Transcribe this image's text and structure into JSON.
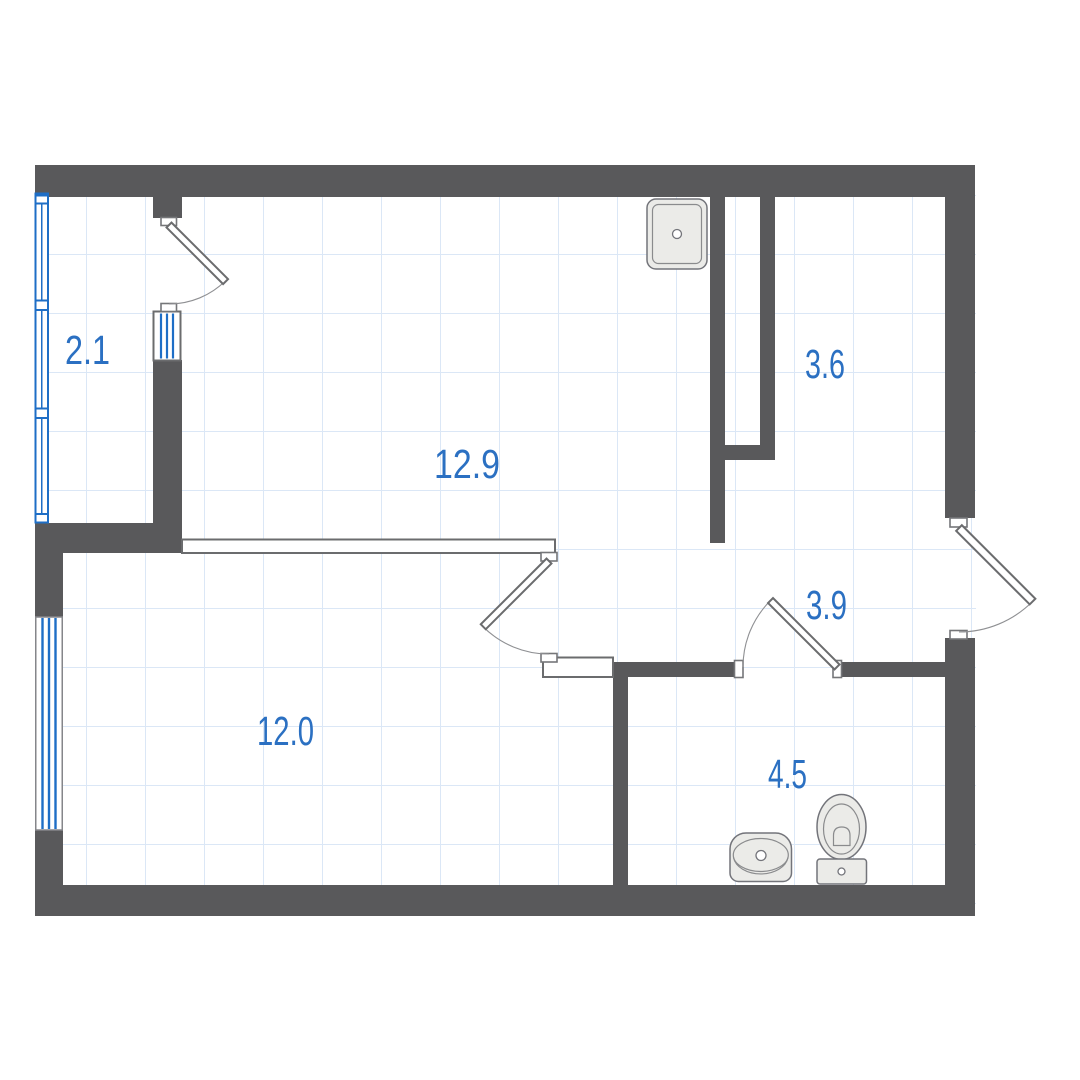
{
  "floorplan": {
    "type": "apartment-floor-plan",
    "rooms": [
      {
        "name": "balcony",
        "area": "2.1"
      },
      {
        "name": "living-room-kitchen",
        "area": "12.9"
      },
      {
        "name": "hall",
        "area": "3.6"
      },
      {
        "name": "corridor",
        "area": "3.9"
      },
      {
        "name": "bedroom",
        "area": "12.0"
      },
      {
        "name": "bathroom",
        "area": "4.5"
      }
    ],
    "fixtures": [
      {
        "icon": "kitchen-sink-icon"
      },
      {
        "icon": "washbasin-icon"
      },
      {
        "icon": "toilet-icon"
      }
    ],
    "colors": {
      "wall": "#59595b",
      "window_blue": "#1e6ec6",
      "label_blue": "#2b70c2",
      "grid_blue": "#dbe7f6",
      "fixture_fill": "#ebebe8",
      "outline_gray": "#6b6c6e"
    }
  }
}
